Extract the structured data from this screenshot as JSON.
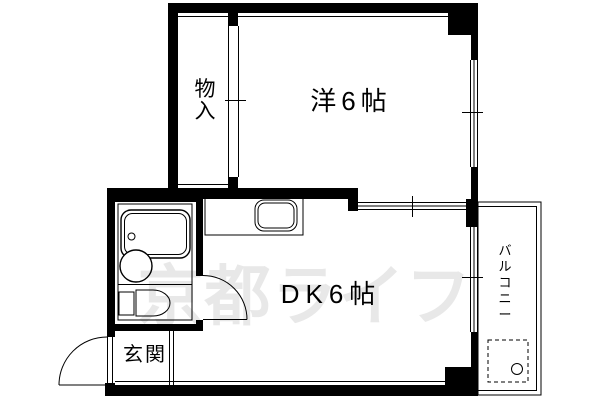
{
  "plan": {
    "type": "apartment-floorplan",
    "watermark": {
      "text": "京都ライフ",
      "color": "#e8e8e8"
    },
    "labels": {
      "western_room": "洋6帖",
      "dining_kitchen": "DK6帖",
      "closet": "物入",
      "closet_chars": [
        "物",
        "入"
      ],
      "entrance": "玄関",
      "balcony": "バルコニー",
      "balcony_chars": [
        "バ",
        "ル",
        "コ",
        "ニ",
        "ー"
      ]
    },
    "colors": {
      "wall": "#000000",
      "background": "#ffffff",
      "watermark": "#e8e8e8"
    }
  }
}
